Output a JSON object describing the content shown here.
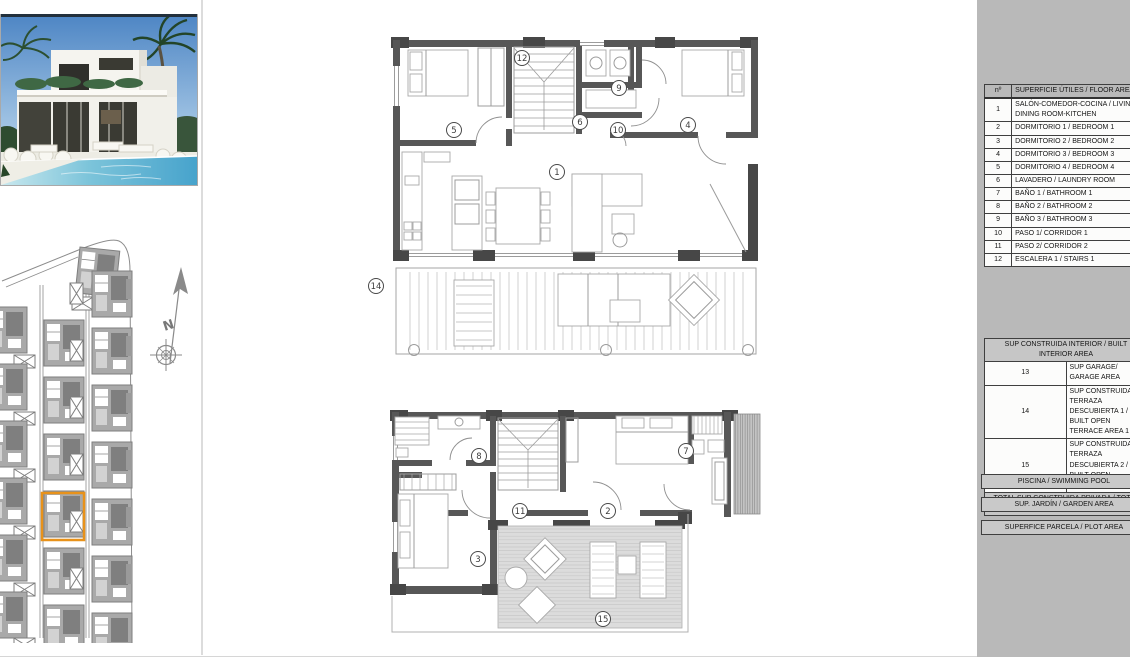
{
  "area_table": {
    "header": {
      "col1": "nº",
      "col2": "SUPERFICIE ÚTILES / FLOOR AREA"
    },
    "rows": [
      {
        "n": "1",
        "label": "SALÓN-COMEDOR-COCINA / LIVING-DINING ROOM-KITCHEN"
      },
      {
        "n": "2",
        "label": "DORMITORIO 1 / BEDROOM 1"
      },
      {
        "n": "3",
        "label": "DORMITORIO 2 / BEDROOM 2"
      },
      {
        "n": "4",
        "label": "DORMITORIO 3 / BEDROOM 3"
      },
      {
        "n": "5",
        "label": "DORMITORIO 4 / BEDROOM 4"
      },
      {
        "n": "6",
        "label": "LAVADERO / LAUNDRY ROOM"
      },
      {
        "n": "7",
        "label": "BAÑO 1 / BATHROOM 1"
      },
      {
        "n": "8",
        "label": "BAÑO 2 / BATHROOM 2"
      },
      {
        "n": "9",
        "label": "BAÑO 3 / BATHROOM 3"
      },
      {
        "n": "10",
        "label": "PASO 1/ CORRIDOR 1"
      },
      {
        "n": "11",
        "label": "PASO 2/ CORRIDOR 2"
      },
      {
        "n": "12",
        "label": "ESCALERA 1 / STAIRS 1"
      }
    ],
    "sections": [
      {
        "type": "header",
        "label": "SUP CONSTRUIDA INTERIOR / BUILT INTERIOR AREA"
      },
      {
        "type": "row",
        "n": "13",
        "label": "SUP GARAGE/ GARAGE AREA"
      },
      {
        "type": "row",
        "n": "14",
        "label": "SUP CONSTRUIDA TERRAZA DESCUBIERTA 1 / BUILT OPEN TERRACE AREA 1"
      },
      {
        "type": "row",
        "n": "15",
        "label": "SUP CONSTRUIDA TERRAZA DESCUBIERTA 2 / BUILT OPEN TERRACE AREA 2"
      },
      {
        "type": "total",
        "label": "TOTAL SUP CONSTRUIDA PRIVADA / TOTAL BUILT PRIVATE AREA"
      }
    ],
    "footer_rows": [
      "PISCINA / SWIMMING POOL",
      "SUP. JARDÍN / GARDEN AREA",
      "SUPERFICE PARCELA / PLOT AREA"
    ]
  },
  "plan_labels": {
    "upper": [
      "12",
      "9",
      "5",
      "6",
      "10",
      "4",
      "1",
      "14"
    ],
    "lower": [
      "8",
      "7",
      "11",
      "2",
      "3",
      "15"
    ]
  },
  "site_plan": {
    "north_label": "N",
    "highlight_color": "#E8921A"
  },
  "colors": {
    "panel_gray": "#B9B9B9",
    "wall_gray": "#575757",
    "accent_orange": "#E8921A",
    "pool_blue": "#47A3CC"
  }
}
